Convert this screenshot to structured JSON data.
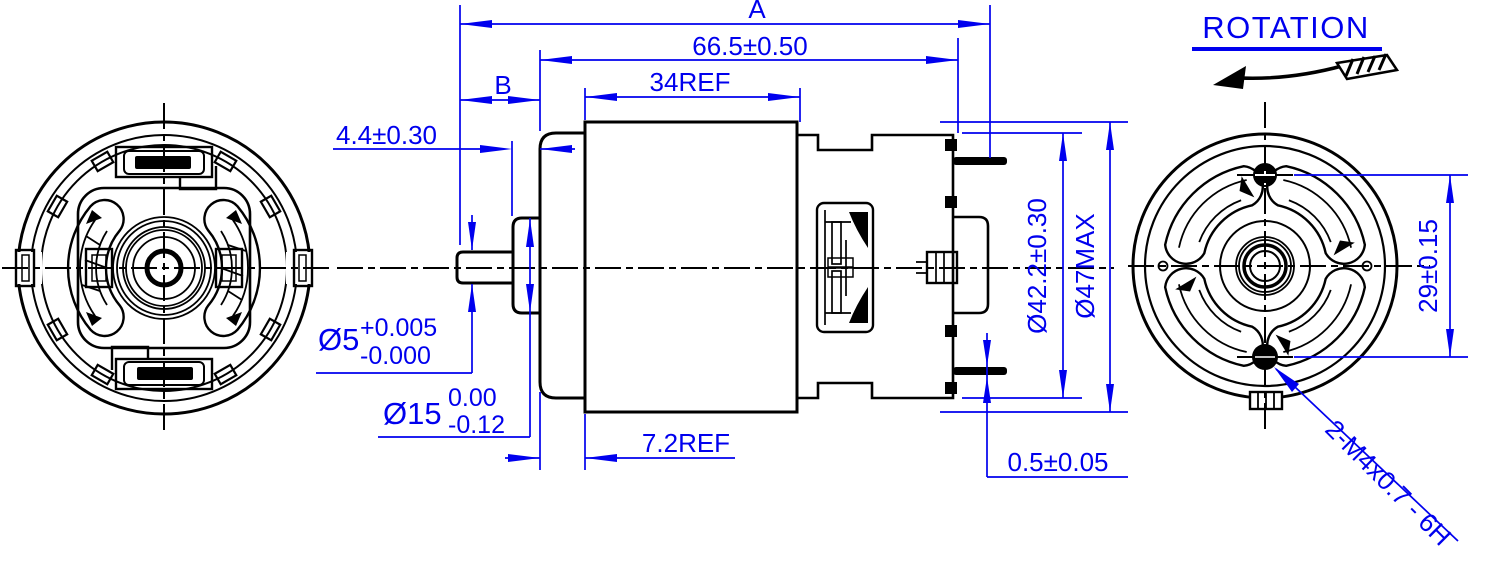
{
  "drawing": {
    "type": "engineering-drawing-dc-motor",
    "colors": {
      "line": "#000000",
      "dimension": "#0000ee",
      "background": "#ffffff"
    },
    "rotation": {
      "label": "ROTATION"
    },
    "dims": {
      "overall_length": "A",
      "case_length": "66.5±0.50",
      "shaft_extension": "B",
      "body_length": "34REF",
      "boss_height": "4.4±0.30",
      "shaft_dia": {
        "nominal": "Ø5",
        "upper": "+0.005",
        "lower": "-0.000"
      },
      "boss_dia": {
        "nominal": "Ø15",
        "upper": "0.00",
        "lower": "-0.12"
      },
      "endcap_length": "7.2REF",
      "endcap_dia": "Ø42.2±0.30",
      "body_dia": "Ø47MAX",
      "terminal_thickness": "0.5±0.05",
      "hole_spacing": "29±0.15",
      "mounting_thread": "2-M4x0.7 - 6H"
    }
  }
}
